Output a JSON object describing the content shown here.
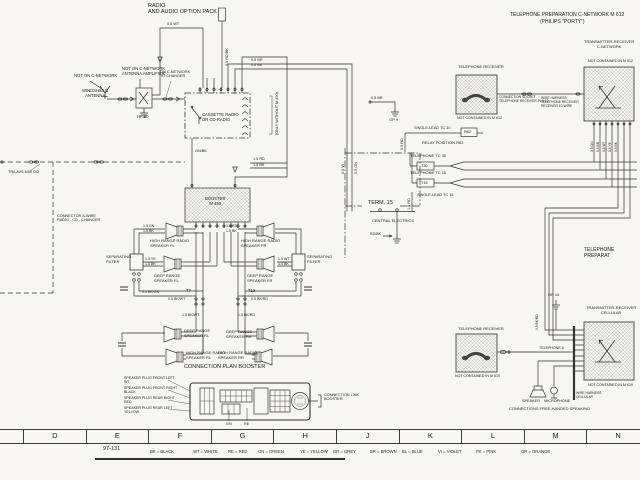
{
  "labels": {
    "t_radio": "RADIO\nAND AUDIO OPTION PACK",
    "t_telprep1": "TELEPHONE PREPARATION C-NETWORK    M 612",
    "t_telprep2": "(PHILIPS \"PORTY\")",
    "t_telprep_r": "TELEPHONE PREPARAT",
    "ant_not": "NOT ON C-NETWORK",
    "ant_ws": "WINDSHIELD\nANTENNA",
    "amp_not": "NOT ON C-NETWORK\nANTENNA AMPLIFIER",
    "amp_hf": "HF 90",
    "chg": "ON C-NETWORK\nTO CHANGER",
    "radio_box": "CASSETTE RADIO\nOR CD-RADIO",
    "radio_side": "(ONLY WITHOUT M 490)",
    "booster": "BOOSTER\nM 490",
    "tra": "TRA AVS 6/50 OO",
    "conn_cd": "CONNECTOR A-WIRE\nRADIO - CD - CHANGER",
    "spk_fl_h": "HIGH RANGE RADIO\nSPEAKER FL",
    "spk_fl_d": "DEEP RANGE\nSPEAKER FL",
    "spk_fr_h": "HIGH RANGE RADIO\nSPEAKER FR",
    "spk_fr_d": "DEEP RANGE\nSPEAKER FR",
    "filt_l": "SEPARATING\nFILTER",
    "filt_r": "SEPARATING\nFILTER",
    "t7": "T7",
    "t13": "T13",
    "spk_rl_d": "DEEP RANGE\nSPEAKER RL",
    "spk_rl_h": "HIGH RANGE RADIO\nSPEAKER RL",
    "spk_rr_d": "DEEP RANGE\nSPEAKER RR",
    "spk_rr_h": "HIGH RANGE RADIO\nSPEAKER RR",
    "cp_title": "CONNECTION PLAN BOOSTER",
    "cp1": "SPEAKER PLUG FRONT LEFT\nWT",
    "cp2": "SPEAKER PLUG FRONT RIGHT\nBLACK",
    "cp3": "SPEAKER PLUG REAR RIGHT\nRED",
    "cp4": "SPEAKER PLUG REAR LEFT\nYELLOW",
    "cp_link": "CONNECTION LINK\nBOOSTER",
    "cp_gn": "GN",
    "cp_re": "RE",
    "gp9": "GP 9",
    "w_gbr": "0.5 BR",
    "sl30": "SINGLE-LEAD TC 30",
    "r62": "R62",
    "relay": "RELAY POSITION R62",
    "tel30": "TELEPHONE TC 30",
    "t30": "T30",
    "tel15": "TELEPHONE TC 15",
    "t15": "T15",
    "sl15": "SINGLE-LEAD TC 15",
    "term15": "TERM. 15",
    "ce": "CENTRAL ELECTRICS",
    "rdbk": "RD/BK",
    "recv1": "TELEPHONE RECEIVER",
    "recv1_not": "NOT CONTAINED IN M 612",
    "recv1_conn": "CONNECTION SOCKET\nTELEPHONE RECEIVER PLA 10",
    "harness1": "WIRE HARNESS\nTELEPHONE RECEIVER\nRECEIVER 10-WIRE",
    "trx1": "TRANSMITTER-RECEIVER\nC-NETWORK",
    "trx1_not": "NOT CONTAINED IN M 612",
    "gp14": "GP 14",
    "trx2": "TRANSMITTER-RECEIVER\nCELLULAR",
    "trx2_not": "NOT CONTAINED IN M 619",
    "recv2": "TELEPHONE RECEIVER",
    "recv2_not": "NOT CONTAINED IN M 619",
    "telA": "TELEPHONE A",
    "spk_lbl": "SPEAKER",
    "mic_lbl": "MICROPHONE",
    "freehand": "CONNECTIONS FREE-HANDED SPEAKING",
    "wh_cell": "WIRE HARNESS\nCELLULAR",
    "w_pwr": "0.5 WT",
    "w_fuse": "0.5 RD/BK",
    "w_br": "0.5 BR",
    "w_bk": "0.5 BK",
    "w_rd15": "1.5 RD",
    "w_bk15": "1.5 BK",
    "w_gnbk": "GN/BK",
    "w_vi": "0.5 VI",
    "w_gn2": "0.5 GN",
    "w_rd": "0.5 RD",
    "w_rd15b": "1.5 RD",
    "wfl1": "1.5 GN",
    "wfl2": "1.5 BK",
    "wfl3": "1.5 YE",
    "wfl4": "1.5 BK",
    "wfr1": "1.5 RD",
    "wfr2": "1.5 BK",
    "wfr3": "1.5 WT",
    "wfr4": "1.5 BK",
    "t7a": "0.5 BK/GN",
    "t7b": "0.5 BK/WT",
    "t13a": "0.5 BK/RD",
    "wb1": "1.5 BK/WT",
    "wb2": "1.5 BK/RD",
    "p1": "0.5 GN",
    "p2": "0.5 BR",
    "p3": "0.5 WT",
    "p4": "0.5 YE",
    "p5": "0.5 BK",
    "cellw": "0.5 BK/RD"
  },
  "legend": {
    "sheet": "97-131",
    "grid": [
      "D",
      "E",
      "F",
      "G",
      "H",
      "J",
      "K",
      "L",
      "M",
      "N"
    ],
    "colors": [
      "BK = BLACK",
      "WT = WHITE",
      "RE = RED",
      "GN = GREEN",
      "YE = YELLOW",
      "GR = GREY",
      "BR = BROWN",
      "BL = BLUE",
      "VI = VIOLET",
      "PK = PINK",
      "OR = ORANGE"
    ]
  },
  "colors": {
    "ink": "#333333",
    "hatch": "#999999",
    "paper": "#f7f6f3"
  }
}
